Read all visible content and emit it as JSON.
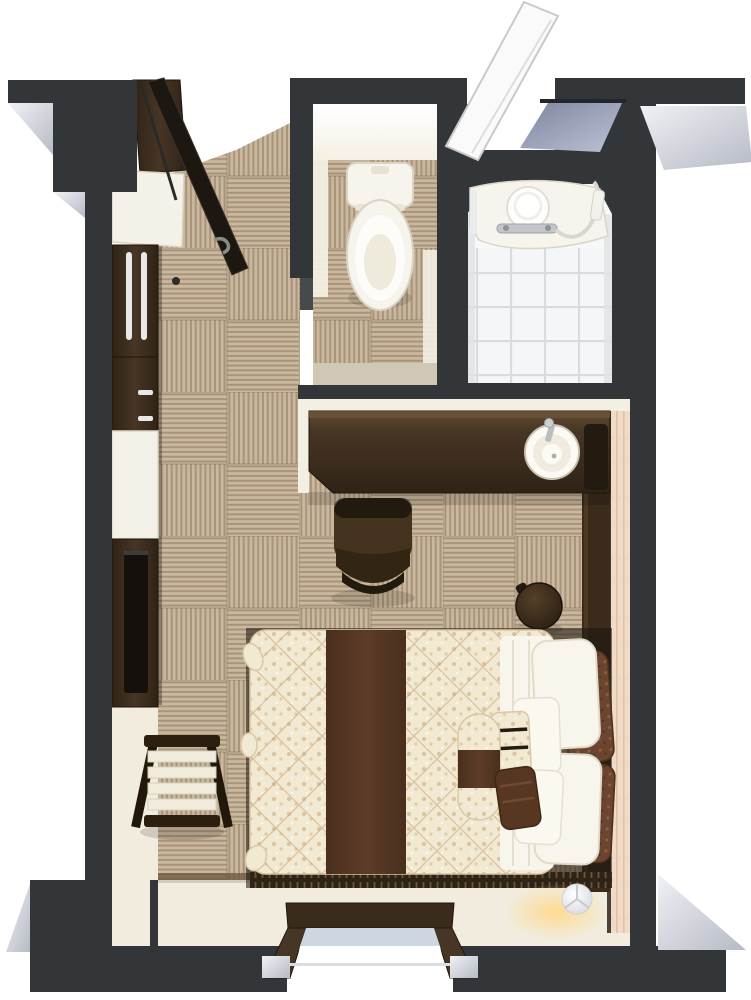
{
  "meta": {
    "kind": "3d-floorplan-render",
    "description": "Top-down 3D render of a compact hotel guest room with toilet room, unit bathroom, desk with basin, double bed and window",
    "canvas": {
      "width": 751,
      "height": 1000
    }
  },
  "palette": {
    "outside": "#ffffff",
    "wall": "#333639",
    "wall-dark": "#232527",
    "bevel-a": "#f0f1f6",
    "bevel-b": "#b6bac4",
    "trim": "#f3efe2",
    "trim-shadow": "#cfc8b5",
    "cream": "#f1ecdd",
    "carpet-base": "#c9b89d",
    "carpet-stripe": "#a8927a",
    "carpet-seam": "#6b5b45",
    "carpet-edge": "#6a563e",
    "wood-dark": "#2f2316",
    "wood-mid": "#473525",
    "wood-light": "#60492f",
    "wood-face": "#3a2b1b",
    "black-panel": "#15100b",
    "handle": "#e8e8e6",
    "fixture": "#f6f4ec",
    "fixture-shade": "#d8d3c2",
    "tile": "#f4f6f7",
    "tile-line": "#d7dce0",
    "glass-a": "#7e86a0",
    "glass-b": "#bcc3d5",
    "window-glass": "#ccd7e1",
    "duvet": "#f2e9d2",
    "duvet-dot": "#dcc49e",
    "quilt-line": "#c8a87e",
    "runner": "#5d3c28",
    "runner-dark": "#4a2f1e",
    "pillow": "#f8f5ec",
    "pillow-shade": "#e2ddcb",
    "cushion": "#6b4530",
    "cushion-dot": "#8f5f41",
    "accent": "#f0dbc6",
    "accent-line": "#dfc0a5",
    "steel": "#b9bcc0",
    "glow": "#ffd98f"
  },
  "rooms": [
    {
      "id": "entry-hall",
      "floor": "carpet-tile"
    },
    {
      "id": "toilet-room",
      "floor": "carpet-tile"
    },
    {
      "id": "bathroom",
      "floor": "white-tile"
    },
    {
      "id": "bedroom",
      "floor": "carpet-tile"
    },
    {
      "id": "window-bay",
      "floor": "cream-vinyl"
    }
  ],
  "furniture": [
    "entrance-door",
    "white-entry-door",
    "entry-cabinet",
    "entry-counter",
    "wardrobe",
    "lower-cabinet",
    "white-cabinet",
    "media-console",
    "luggage-rack",
    "desk-counter",
    "round-basin",
    "desk-chair",
    "stool",
    "double-bed",
    "bed-runner",
    "white-pillows",
    "brown-cushions",
    "bolster-cushion",
    "headboard-panel",
    "accent-wall-panel",
    "toilet",
    "bath-vanity",
    "hand-shower",
    "floor-lamp",
    "window"
  ]
}
